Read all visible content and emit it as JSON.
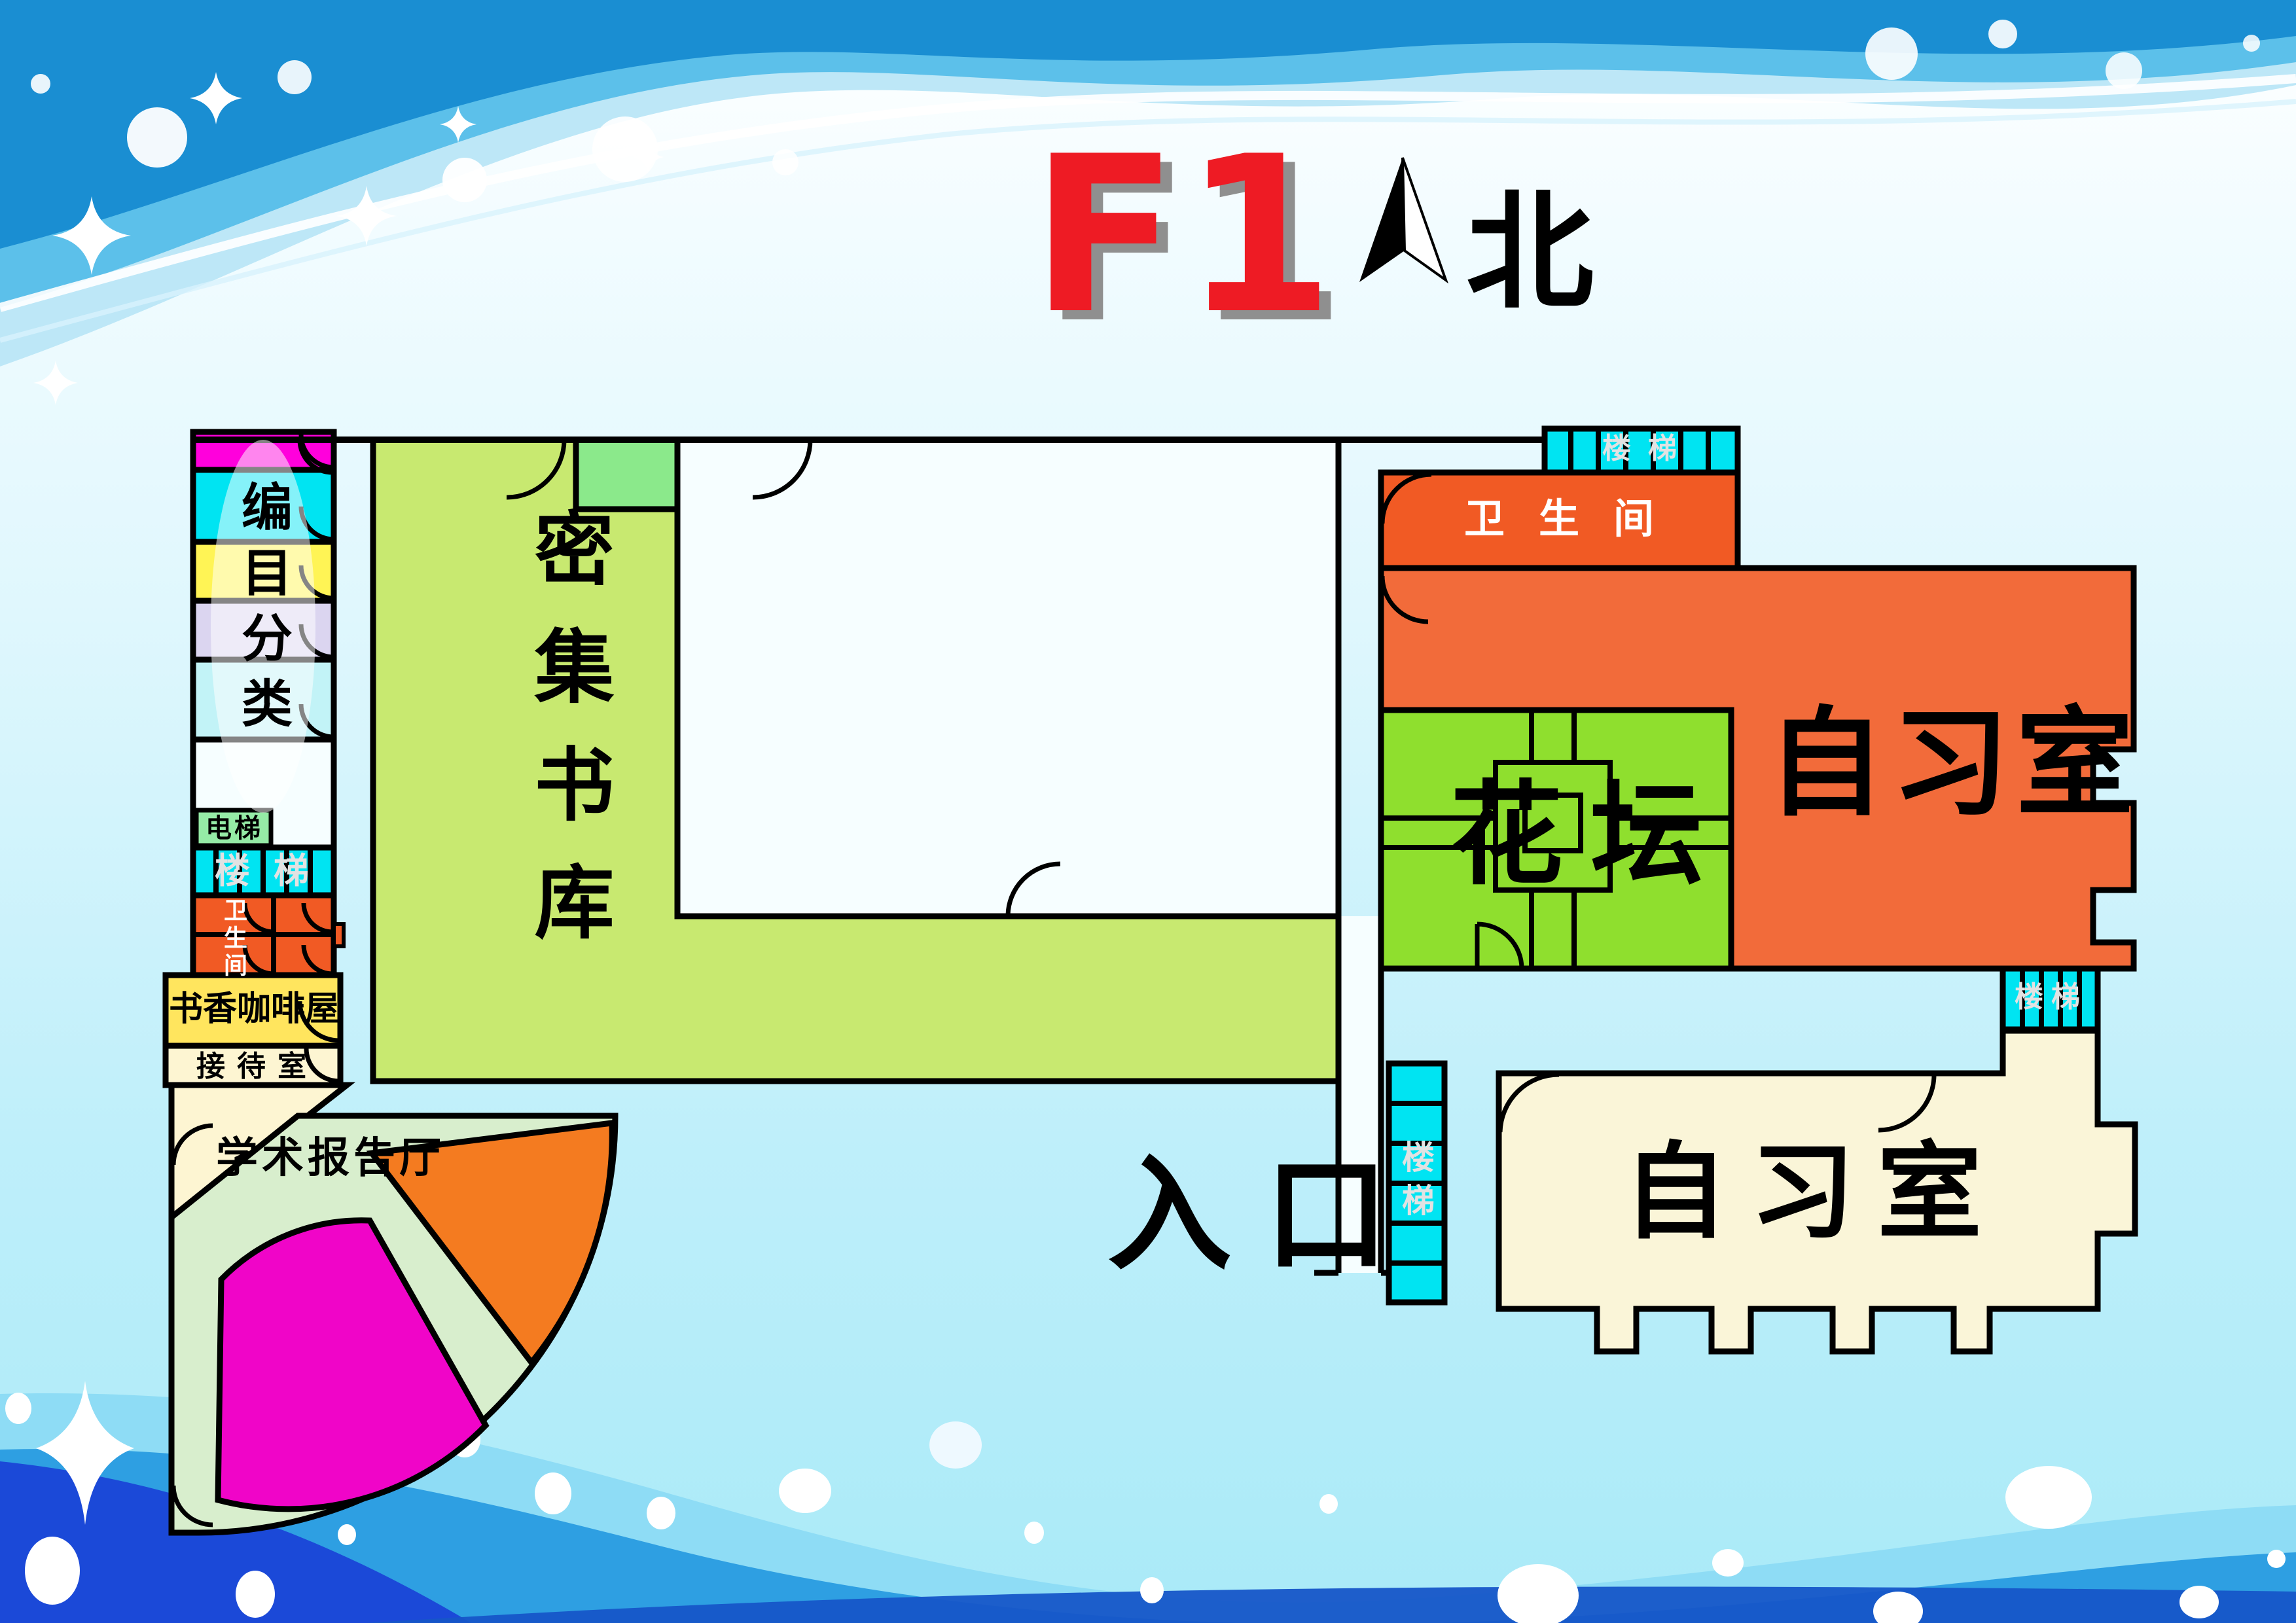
{
  "header": {
    "floor_label": "F1",
    "north_label": "北"
  },
  "map": {
    "labels": {
      "catalog": "编目分类",
      "stack": "密集书库",
      "elevator": "电梯",
      "stairs": "楼梯",
      "restroom": "卫生间",
      "coffee_house": "书香咖啡屋",
      "reception": "接待室",
      "lecture_hall": "学术报告厅",
      "flower_bed": "花坛",
      "study_room": "自习室",
      "entrance": "入口"
    },
    "colors": {
      "title_red": "#ee1b24",
      "wall_black": "#000000",
      "catalog_magenta": "#ff00dc",
      "catalog_cyan": "#00e4f2",
      "catalog_yellow": "#fff455",
      "catalog_lavender": "#dbd5f0",
      "catalog_pale_cyan": "#c2f3f7",
      "elevator_green": "#95eba6",
      "stairs_cyan": "#00e4f2",
      "restroom_orange": "#f15a24",
      "coffee_yellow": "#ffe55e",
      "reception_cream": "#fdf5d2",
      "lecture_fan_green": "#d8eecd",
      "lecture_orange": "#f47b20",
      "lecture_magenta": "#f005c8",
      "stack_green": "#c8e970",
      "stack_annex_green": "#8be98b",
      "flowerbed_green": "#8fdf2e",
      "study_orange": "#f26b3a",
      "study_cream": "#faf5d8",
      "room_white": "#f6feff"
    }
  }
}
